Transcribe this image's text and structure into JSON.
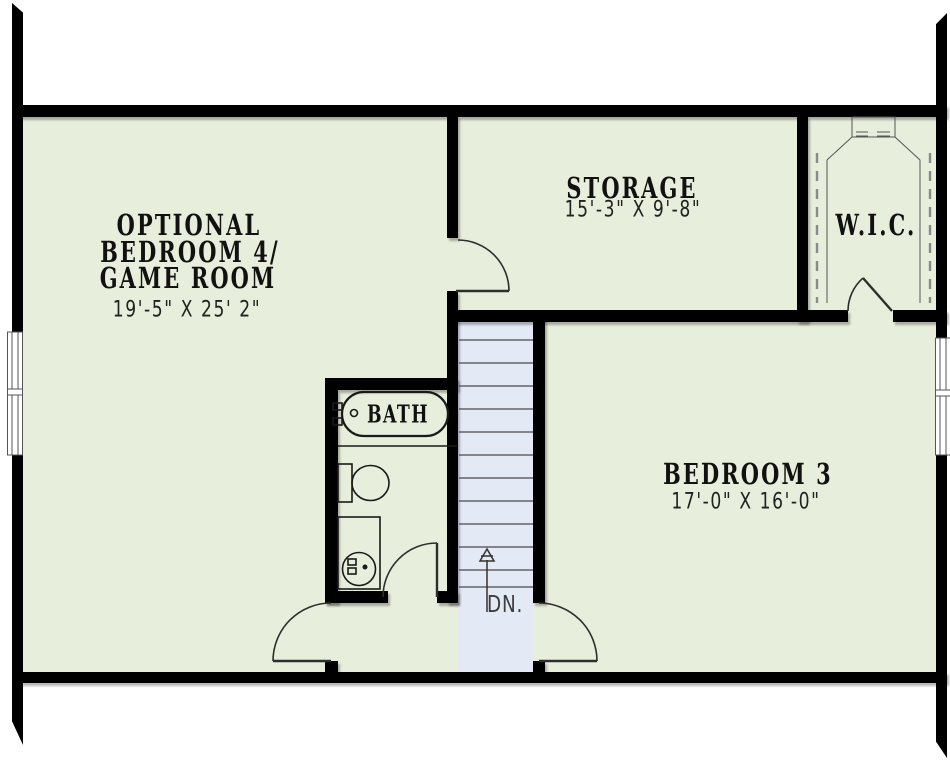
{
  "plan_title": "Upper Floor Plan",
  "colors": {
    "room_fill": "#e7eedb",
    "stair_fill": "#e4e9f6",
    "wall": "#000000",
    "line": "#3a3a3a",
    "fixture_line": "#1a1a1a",
    "text": "#111111",
    "dim_text": "#222222",
    "dn_text": "#3d3d3d"
  },
  "rooms": {
    "game_room": {
      "name_lines": [
        "OPTIONAL",
        "BEDROOM 4/",
        "GAME ROOM"
      ],
      "dimensions": "19'-5\" X 25' 2\""
    },
    "storage": {
      "name": "STORAGE",
      "dimensions": "15'-3\" X 9'-8\""
    },
    "wic": {
      "name": "W.I.C."
    },
    "bath": {
      "name": "BATH"
    },
    "bedroom3": {
      "name": "BEDROOM 3",
      "dimensions": "17'-0\" X 16'-0\""
    },
    "stairs": {
      "direction_label": "DN."
    }
  }
}
